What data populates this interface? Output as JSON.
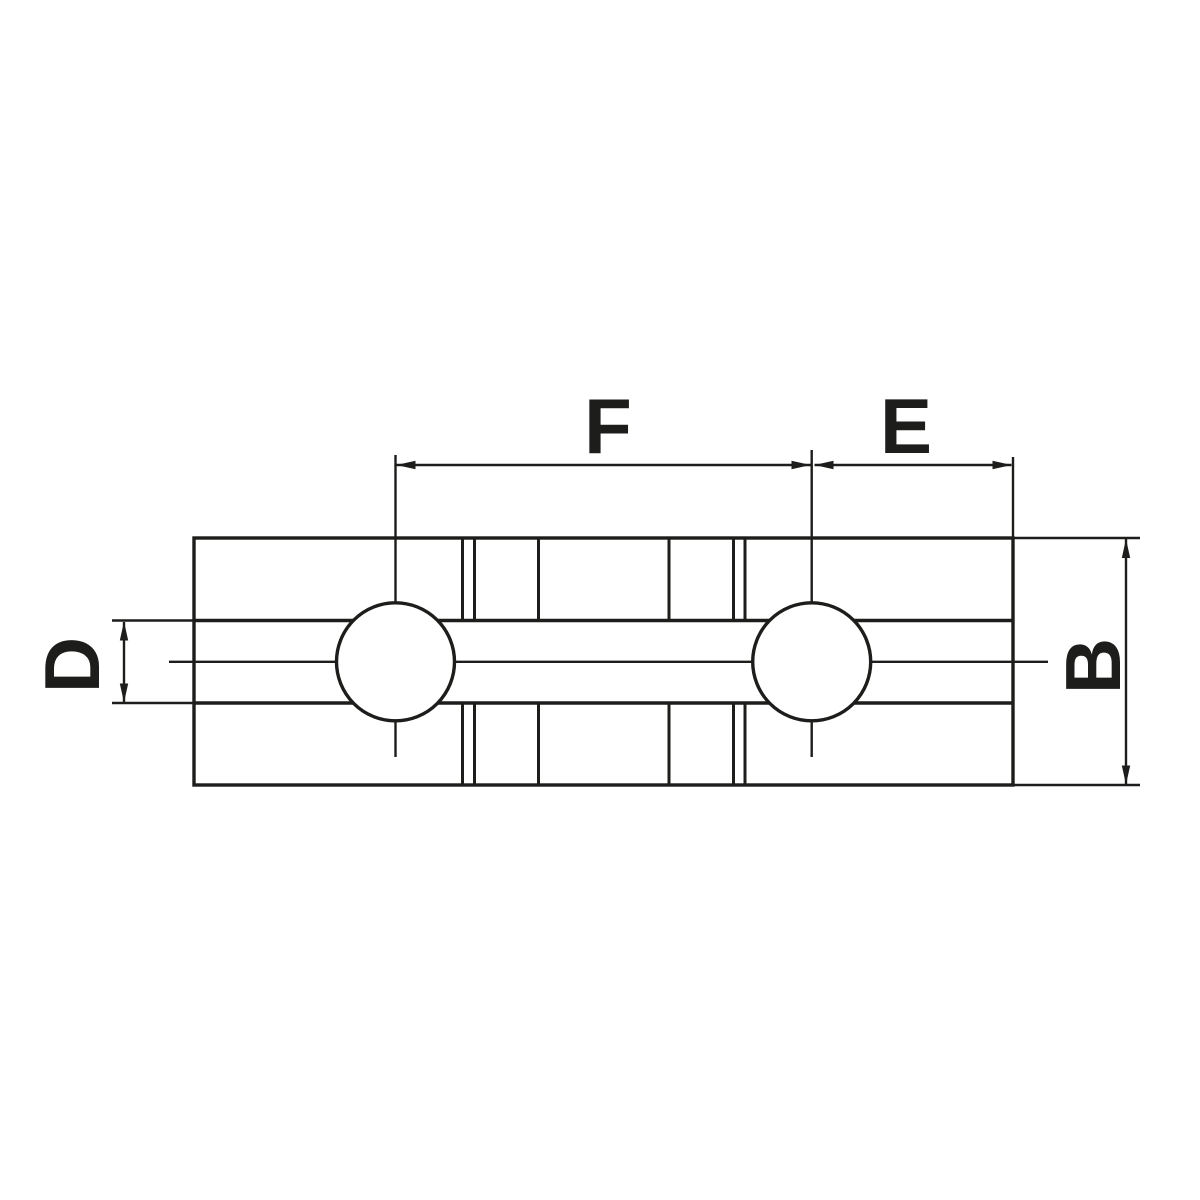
{
  "drawing": {
    "background": "#ffffff",
    "line_color": "#1d1d1b",
    "labels": {
      "hole_spacing": "F",
      "end_distance": "E",
      "body_width": "B",
      "slot_width": "D"
    }
  }
}
